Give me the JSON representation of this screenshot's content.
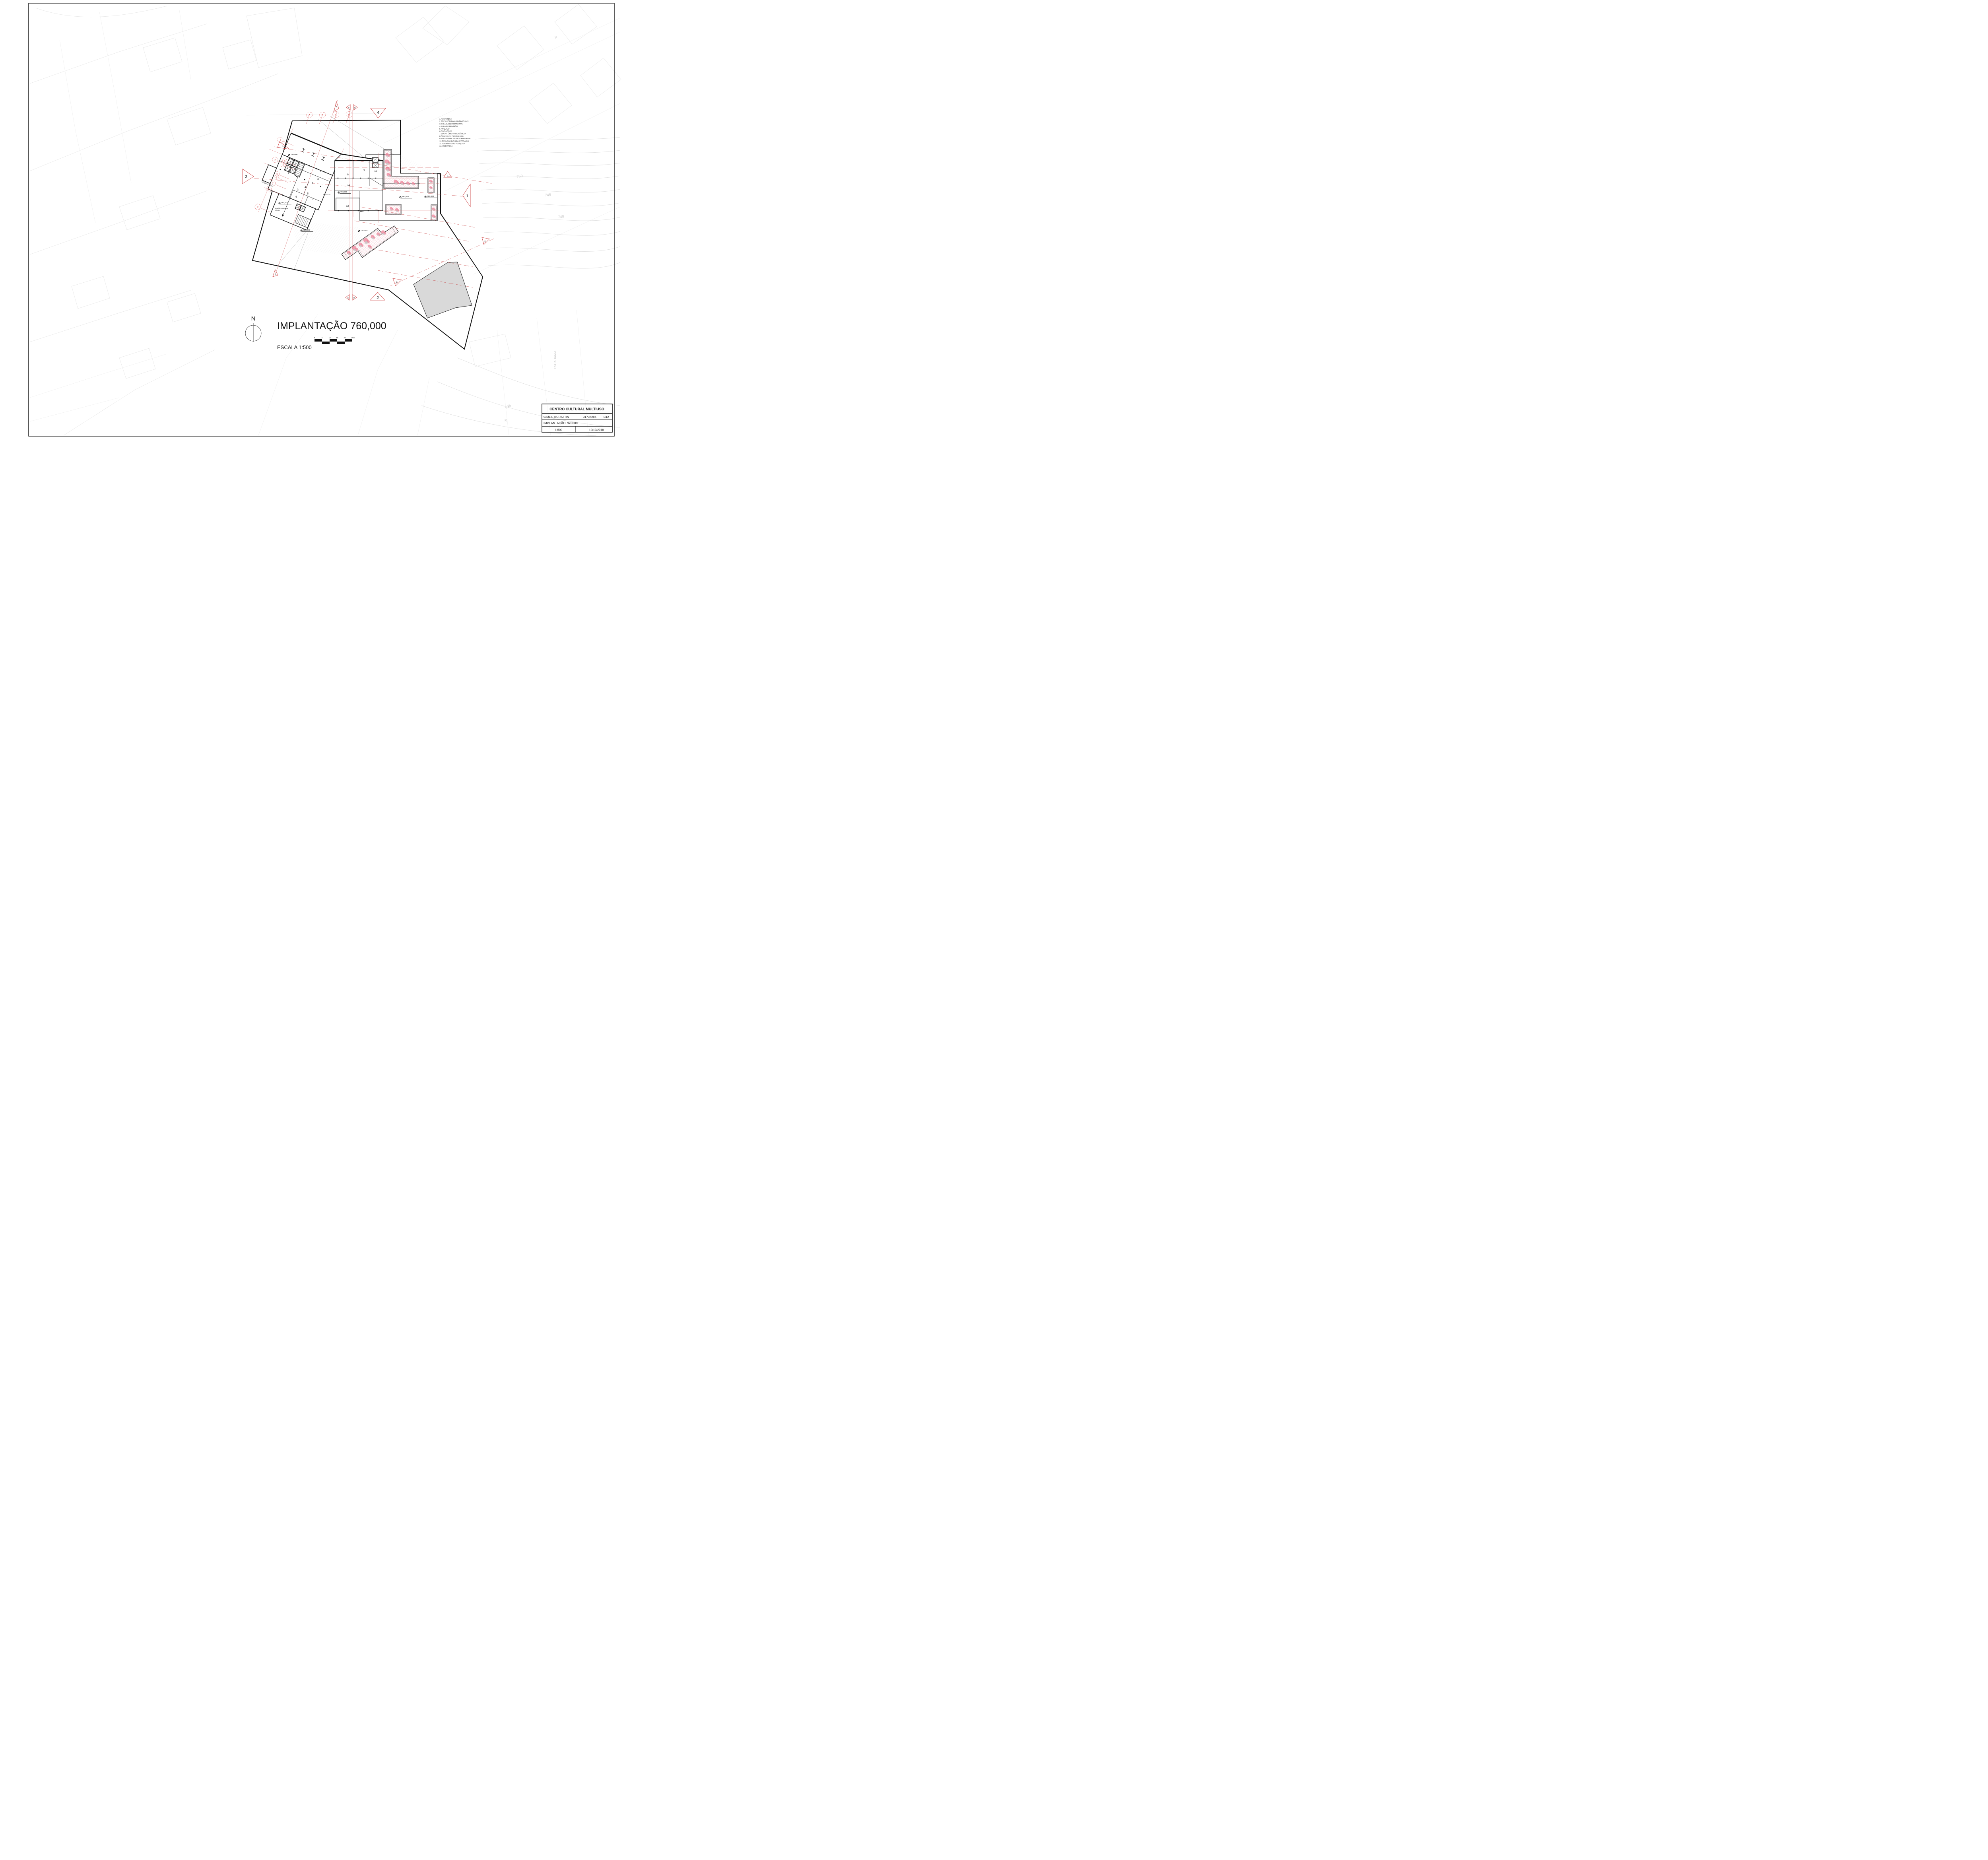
{
  "sheet": {
    "title": "IMPLANTAÇÃO 760,000",
    "scale_label": "ESCALA 1:500",
    "north_label": "N",
    "scale_ticks": [
      "0",
      "5",
      "10",
      "15",
      "20",
      "25m"
    ]
  },
  "legend": {
    "items": [
      "1.AUDIOTECA",
      "2.ÁREA COM BAIAS INDIVIDUAIS",
      "3.SALAS ADMINISTRATIVA",
      "4.SALA DE REUNIÃO",
      "5.ARQUIVO",
      "6.COPIADORA",
      "7.ESCRITÓRIO PANORÂMICO",
      "8.ÁREA PARA PERIÓDICOS",
      "9.SALAS PARA ESTUDO EM GRUPO",
      "10.ESTAÇÃO DO BIBLIOTECÁRIO",
      "11.TERMINAIS DE PESQUISA",
      "12.VIDEOTECA"
    ]
  },
  "title_block": {
    "project": "CENTRO CULTURAL MULTIUSO",
    "author": "GIULIE BURATTIN",
    "student_id": "31737285",
    "class_code": "B12",
    "drawing": "IMPLANTAÇÃO 760,000",
    "scale": "1:500",
    "date": "10/12/2018"
  },
  "plan": {
    "rooms": [
      "1",
      "2",
      "3",
      "4",
      "5",
      "6",
      "7",
      "8",
      "9",
      "10",
      "11",
      "12"
    ],
    "elevations": [
      "760,000",
      "760,000",
      "760,000",
      "760,000",
      "760,000",
      "755,920",
      "751,840"
    ],
    "sections": {
      "top": [
        "B",
        "C",
        "D",
        "4"
      ],
      "left": [
        "A",
        "3"
      ],
      "right": [
        "A",
        "1",
        "E"
      ],
      "bottom": [
        "C",
        "D",
        "2",
        "E",
        "B"
      ]
    },
    "grid": {
      "top": [
        "A",
        "B",
        "C",
        "D"
      ],
      "left": [
        "1",
        "2",
        "3",
        "4",
        "5",
        "6",
        "7",
        "8",
        "9"
      ]
    },
    "contours": [
      "750",
      "745",
      "740",
      "735"
    ],
    "streets": [
      "ESCADARIA",
      "V",
      "R"
    ],
    "annotations": {
      "descida_line1": "descida para andar",
      "descida_line2": "inferior",
      "bebedouro": "Bebedouro"
    }
  },
  "colors": {
    "section_red": "#cc3b3b",
    "tree_pink": "#ee8fa3",
    "hatch_pink": "#f3b8c4",
    "gray_fill": "#d9d9d9"
  }
}
